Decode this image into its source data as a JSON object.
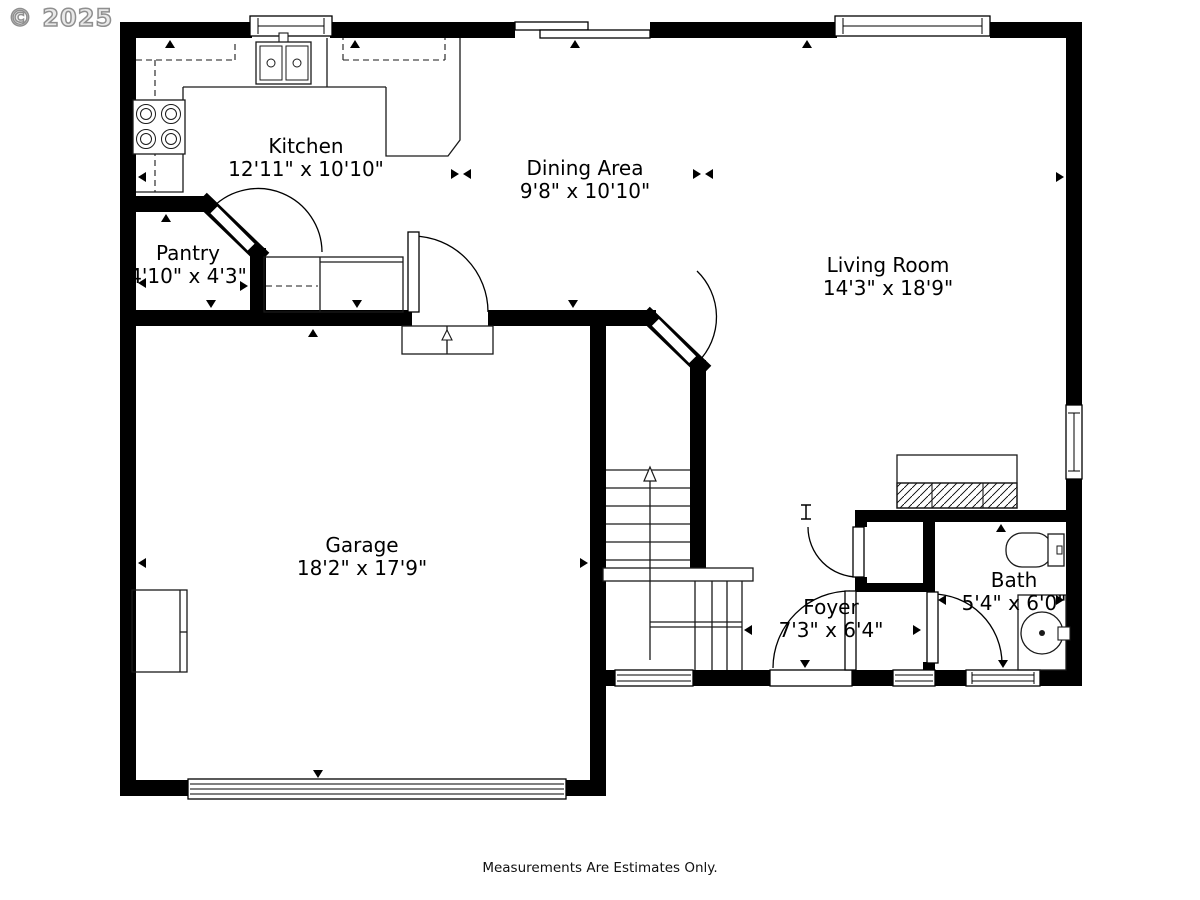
{
  "watermark": "© 2025",
  "footer": {
    "disclaimer": "Measurements Are Estimates Only."
  },
  "rooms": [
    {
      "id": "kitchen",
      "name": "Kitchen",
      "dimensions": "12'11\" x 10'10\""
    },
    {
      "id": "dining",
      "name": "Dining Area",
      "dimensions": "9'8\" x 10'10\""
    },
    {
      "id": "living",
      "name": "Living Room",
      "dimensions": "14'3\" x 18'9\""
    },
    {
      "id": "pantry",
      "name": "Pantry",
      "dimensions": "4'10\" x 4'3\""
    },
    {
      "id": "garage",
      "name": "Garage",
      "dimensions": "18'2\" x 17'9\""
    },
    {
      "id": "foyer",
      "name": "Foyer",
      "dimensions": "7'3\" x 6'4\""
    },
    {
      "id": "bath",
      "name": "Bath",
      "dimensions": "5'4\" x 6'0\""
    }
  ],
  "colors": {
    "walls": "#000000",
    "background": "#ffffff",
    "watermark": "#8f8f8f",
    "text": "#000000"
  }
}
